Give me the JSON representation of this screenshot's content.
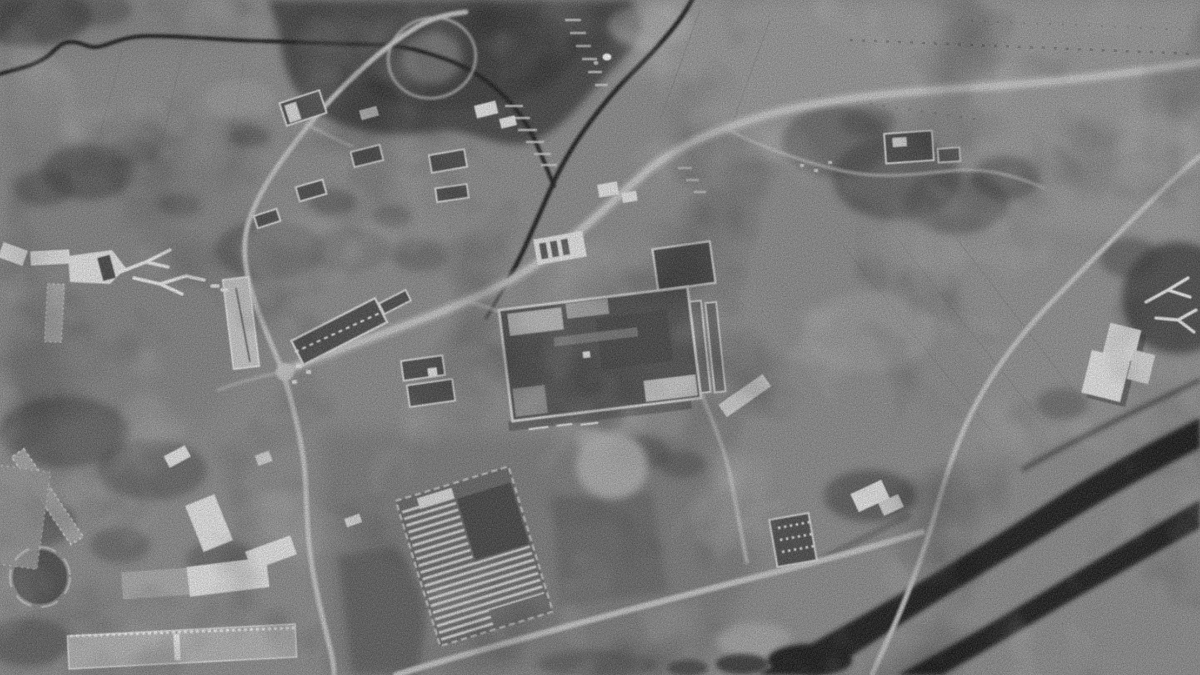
{
  "image": {
    "kind": "reconnaissance satellite photograph",
    "monochrome": true,
    "title": "Grayscale aerial reconnaissance photograph of an industrial village complex",
    "description": "Black-and-white overhead satellite photograph: a large factory hall with bright parapet walls sits at centre among grey farmland; a crossroads west of it links roads running to a village below a dark forested hill, to a barracks-like compound of long white buildings at lower left, and to a ford over dark braided river channels at lower right; striped greenhouse frames, scattered scrub patches, terraced hillside strips and a dark winding stream complete the scene under heavy photographic grain.",
    "palette": {
      "ground": "#8d8d8d",
      "ground_light": "#9e9e9e",
      "ground_dark": "#747474",
      "vegetation_dark": "#3f3f3f",
      "water_dark": "#1c1c1c",
      "road_light": "#c6c6c6",
      "roof_bright": "#e8e8e8",
      "roof_dark": "#4e4e4e",
      "shadow": "#2e2e2e"
    },
    "features": [
      {
        "name": "stream-upper",
        "description": "Dark winding stream along the upper left, flowing east then bending south-east"
      },
      {
        "name": "stream-valley",
        "description": "Stream descending from top centre through a shallow valley toward the village"
      },
      {
        "name": "hill-forest",
        "description": "Dark forested hill at top centre with a light loop track around its western spur"
      },
      {
        "name": "terraced-strips",
        "description": "Short light terrace strips cut into the hillsides"
      },
      {
        "name": "village-houses",
        "description": "Cluster of small courtyard houses with bright roof edges north of the crossroads"
      },
      {
        "name": "valley-road",
        "description": "Main light road climbing north-east up the valley from the crossroads to the far right"
      },
      {
        "name": "crossroads",
        "description": "Bright five-way road junction west of the factory"
      },
      {
        "name": "north-road",
        "description": "Road running north from the crossroads past a long narrow bright building"
      },
      {
        "name": "south-road",
        "description": "Road running south from the crossroads along the compound edge"
      },
      {
        "name": "bottom-road",
        "description": "Road crossing the lower fields toward the river ford"
      },
      {
        "name": "diagonal-road",
        "description": "Long straight road descending from upper right to the river crossing"
      },
      {
        "name": "factory-complex",
        "description": "Large industrial hall with bright walls and mottled dark roof at image centre"
      },
      {
        "name": "factory-outbuildings",
        "description": "Auxiliary sheds, striped bay building and paired long buildings around the hall"
      },
      {
        "name": "antler-paths-west",
        "description": "Branching antler-shaped white footpaths in trees west of the factory"
      },
      {
        "name": "antler-paths-east",
        "description": "Matching branching white footpaths in the tree grove at the right edge"
      },
      {
        "name": "barracks-compound",
        "description": "Compound of long barracks buildings with dotted window lines, lower left"
      },
      {
        "name": "round-feature",
        "description": "Small circular ringed feature inside the lower-left compound"
      },
      {
        "name": "greenhouse-rows",
        "description": "Tilted plot of closely spaced white hotbed / greenhouse rows, lower centre"
      },
      {
        "name": "storage-yard",
        "description": "Small dark yard with rows of white objects south-east of the factory"
      },
      {
        "name": "white-warehouses",
        "description": "Pair of bright warehouses with cast shadows on the right slope"
      },
      {
        "name": "river-braids",
        "description": "Dark braided river channels crossing the lower-right corner"
      },
      {
        "name": "scrub-patches",
        "description": "Irregular dark scrub and tree patches over the grey farmland"
      },
      {
        "name": "vehicle-speck",
        "description": "Single bright vehicle-sized speck beside the upper stream"
      },
      {
        "name": "film-grain",
        "description": "Heavy photographic grain and mottling over the whole frame"
      }
    ]
  }
}
